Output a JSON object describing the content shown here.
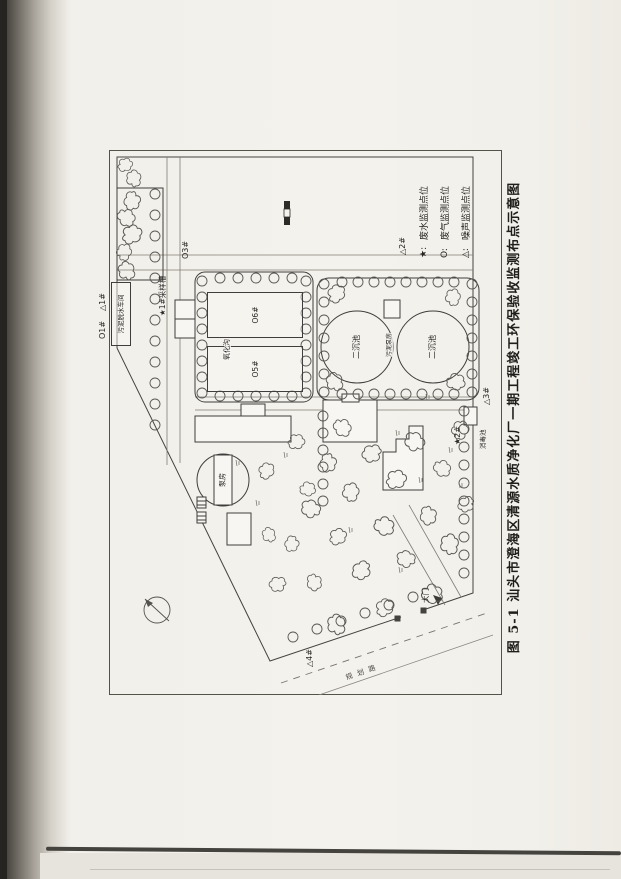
{
  "figure": {
    "caption": "图 5-1  汕头市澄海区清源水质净化厂一期工程竣工环保验收监测布点示意图",
    "legend": [
      {
        "symbol": "★:",
        "label": "废水监测点位"
      },
      {
        "symbol": "O:",
        "label": "废气监测点位"
      },
      {
        "symbol": "△:",
        "label": "噪声监测点位"
      }
    ],
    "map": {
      "markers": {
        "o1": "O1#",
        "n1": "△1#",
        "w1": "★1#采样槽",
        "o3": "O3#",
        "n2": "△2#",
        "w2": "★2#",
        "n3": "△3#",
        "n4": "△4#"
      },
      "structures": {
        "sludge_dewatering": "污泥脱水车间",
        "oxidation_ditch": "氧化沟",
        "o5": "O5#",
        "o6": "O6#",
        "clarifier1": "二沉池",
        "clarifier2": "二沉池",
        "sludge_pump": "污泥泵房",
        "pump_house": "泵房",
        "disinfection": "消毒池",
        "gate": "大门",
        "road": "规划路"
      }
    }
  }
}
